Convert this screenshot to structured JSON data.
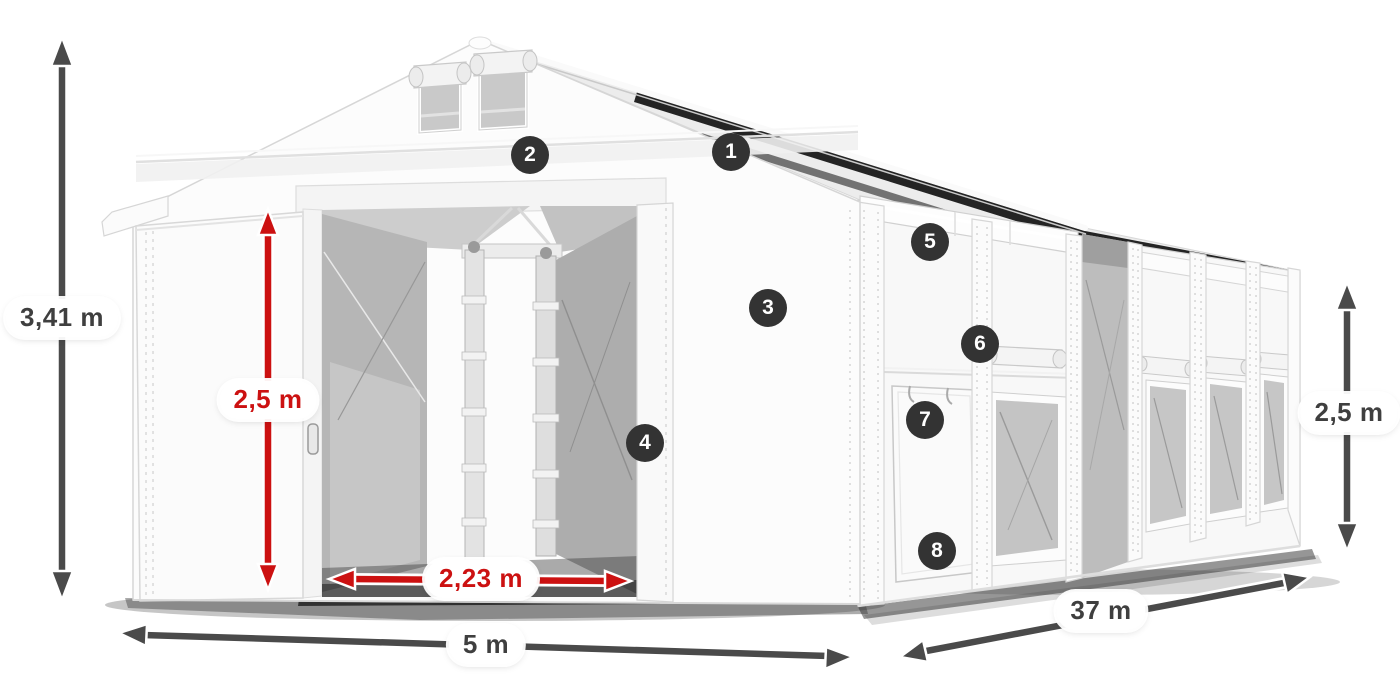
{
  "diagram": {
    "dimensions": {
      "total_height": "3,41 m",
      "entrance_height": "2,5 m",
      "entrance_width": "2,23 m",
      "tent_width": "5 m",
      "tent_length": "37 m",
      "side_height": "2,5 m"
    },
    "callouts": [
      {
        "number": "1"
      },
      {
        "number": "2"
      },
      {
        "number": "3"
      },
      {
        "number": "4"
      },
      {
        "number": "5"
      },
      {
        "number": "6"
      },
      {
        "number": "7"
      },
      {
        "number": "8"
      }
    ],
    "colors": {
      "dimension_red": "#cc1111",
      "dimension_gray": "#4a4a4a",
      "badge_background": "#333333",
      "tent_white": "#fbfbfb",
      "mesh_gray": "#bdbdbd"
    }
  }
}
